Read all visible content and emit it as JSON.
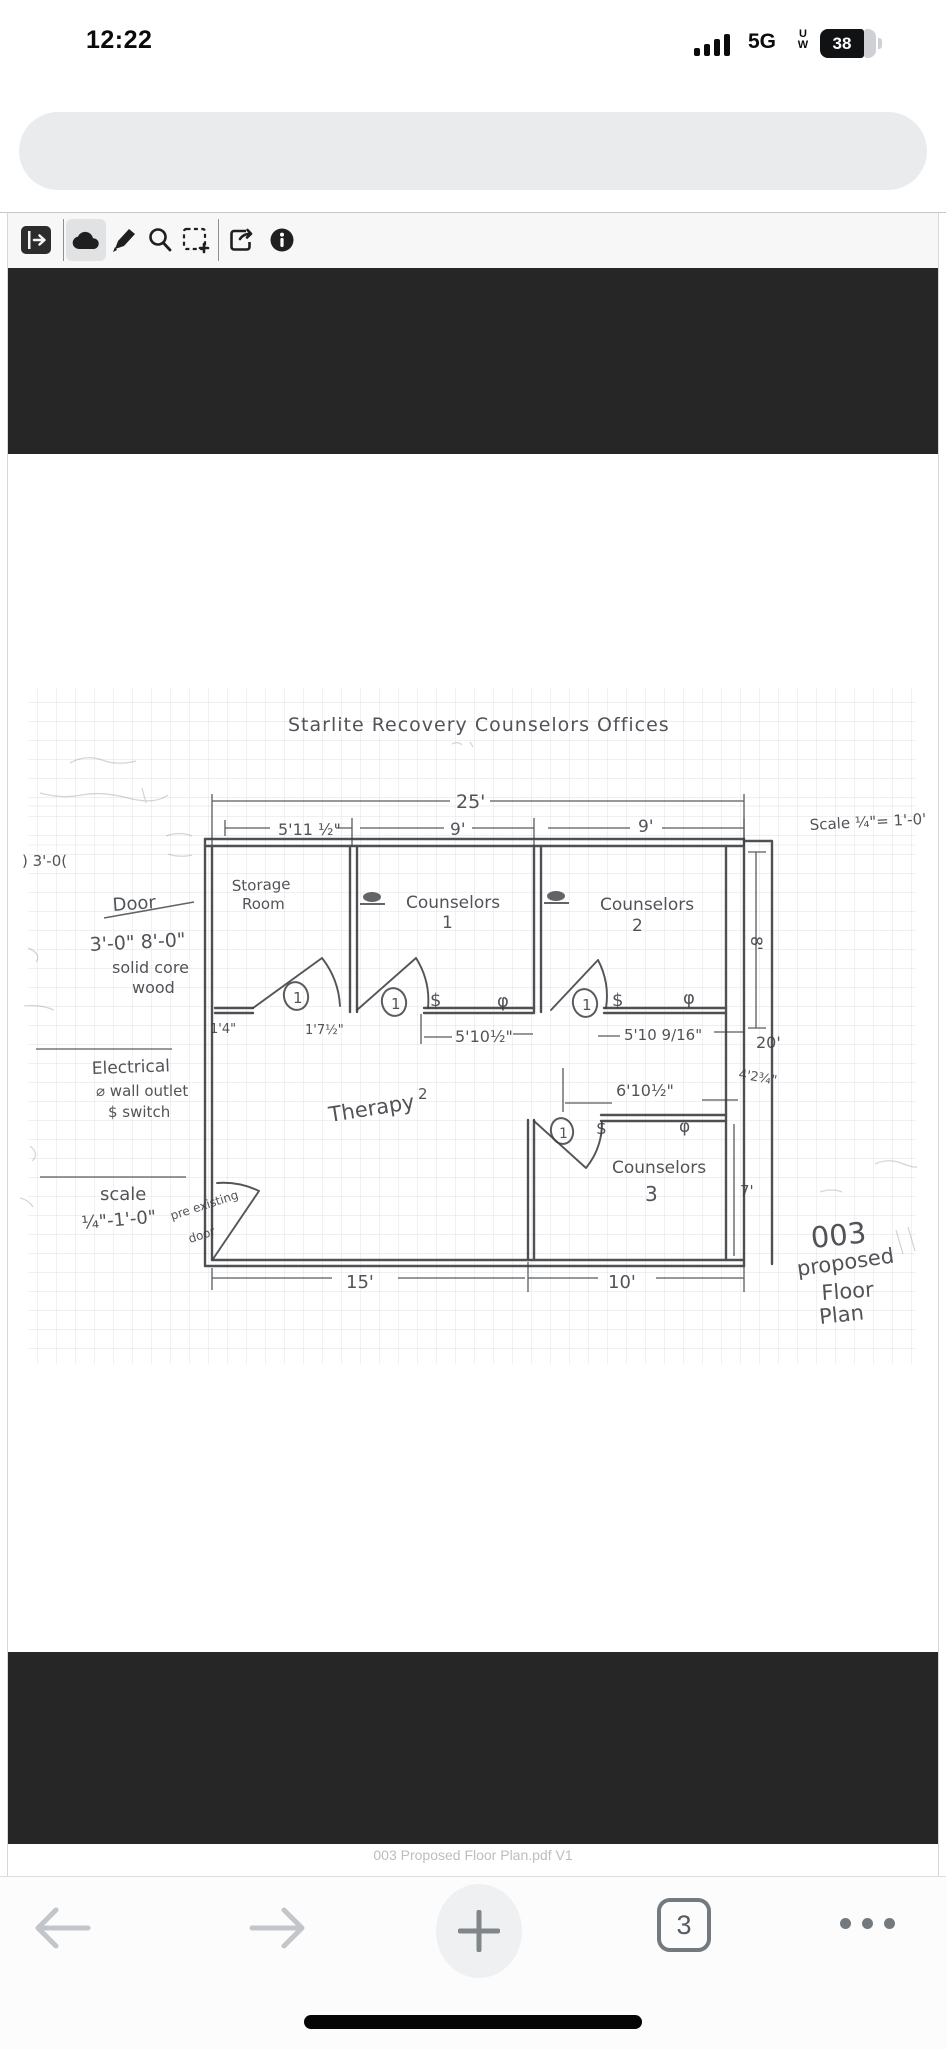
{
  "status_bar": {
    "time": "12:22",
    "carrier": "5G",
    "carrier_sub_top": "U",
    "carrier_sub_bottom": "W",
    "battery_percent": "38"
  },
  "browser": {
    "url": "newbraunfels-tx-us.avolvecloud.com",
    "caption": "003 Proposed Floor Plan.pdf V1",
    "tab_count": "3"
  },
  "pdf_toolbar": {
    "icons": [
      "sidebar-toggle",
      "cloud",
      "annotate",
      "search",
      "snapshot-area",
      "export",
      "info"
    ],
    "selected_icon": "cloud"
  },
  "plan": {
    "title": "Starlite Recovery Counselors Offices",
    "scale_note": "Scale ¼\"= 1'-0'",
    "rooms": {
      "storage1": "Storage",
      "storage2": "Room",
      "c1": "Counselors",
      "c1n": "1",
      "c2": "Counselors",
      "c2n": "2",
      "c3": "Counselors",
      "c3n": "3",
      "therapy": "Therapy",
      "therapyn": "2"
    },
    "dims": {
      "d25": "25'",
      "d511": "5'11 ½\"",
      "d9a": "9'",
      "d9b": "9'",
      "d14": "1'4\"",
      "d17": "1'7½\"",
      "d510a": "5'10½\"",
      "d510b": "5'10 9/16\"",
      "d610": "6'10½\"",
      "d8": "8'",
      "d20": "20'",
      "d42": "4'2¾\"",
      "d7": "7'",
      "d15": "15'",
      "d10": "10'",
      "d30": ") 3'-0("
    },
    "notes": {
      "door1": "Door",
      "door2": "3'-0\" 8'-0\"",
      "door3": "solid core",
      "door4": "wood",
      "elec1": "Electrical",
      "elec2": "⌀ wall outlet",
      "elec3": "$ switch",
      "scale1": "scale",
      "scale2": "¼\"-1'-0\"",
      "pre1": "pre existing",
      "pre2": "door"
    },
    "sheet": {
      "l1": "003",
      "l2": "proposed",
      "l3": "Floor",
      "l4": "Plan"
    },
    "symbols": {
      "door_number": "1",
      "switch": "$",
      "outlet": "φ"
    }
  }
}
